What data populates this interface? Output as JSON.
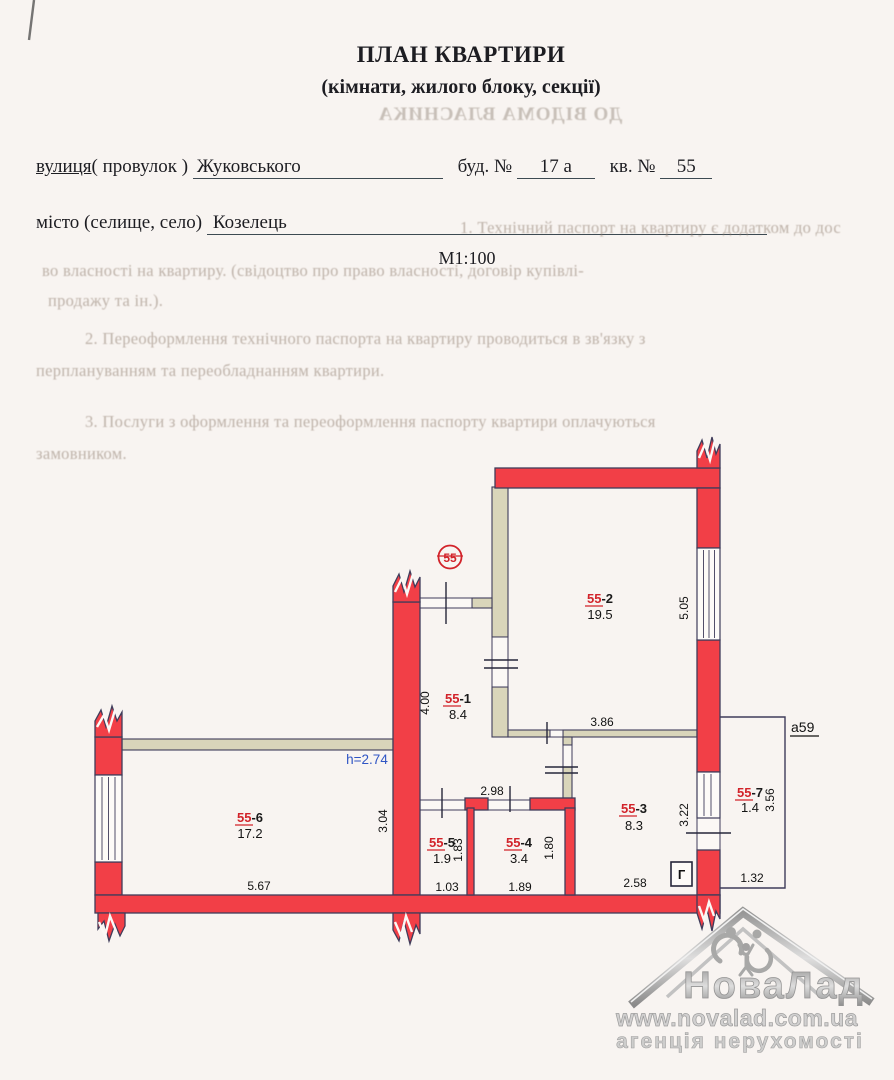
{
  "header": {
    "title": "ПЛАН КВАРТИРИ",
    "subtitle": "(кімнати, жилого блоку, секції)",
    "street_word": "вулиця",
    "street_rest": "( провулок )",
    "street_value": "Жуковського",
    "building_label": "буд. №",
    "building_value": "17 а",
    "apartment_label": "кв. №",
    "apartment_value": "55",
    "city_word1": "місто (",
    "city_word2": "селище",
    "city_word3": ", село)",
    "city_value": "Козелець",
    "scale": "М1:100"
  },
  "bleed_through": {
    "mirrored_notice": "ДО ВІДОМА ВЛАСНИКА",
    "lines": [
      "1. Технічний паспорт на квартиру є додатком до дос",
      "во власності на квартиру. (свідоцтво про право власності, договір купівлі-",
      "продажу та ін.).",
      "2. Переоформлення технічного паспорта на квартиру проводиться в зв'язку з",
      "перплануванням та переобладнанням квартири.",
      "3. Послуги з оформлення та переоформлення паспорту квартири оплачуються",
      "замовником."
    ]
  },
  "plan": {
    "apartment_badge": "55",
    "height_note": "h=2.74",
    "annex_label": "a59",
    "gas_label": "Г",
    "rooms": [
      {
        "num": "55",
        "suffix": "-1",
        "area": "8.4"
      },
      {
        "num": "55",
        "suffix": "-2",
        "area": "19.5"
      },
      {
        "num": "55",
        "suffix": "-3",
        "area": "8.3"
      },
      {
        "num": "55",
        "suffix": "-4",
        "area": "3.4"
      },
      {
        "num": "55",
        "suffix": "-5",
        "area": "1.9"
      },
      {
        "num": "55",
        "suffix": "-6",
        "area": "17.2"
      },
      {
        "num": "55",
        "suffix": "-7",
        "area": "1.4"
      }
    ],
    "dimensions": [
      "4.00",
      "5.05",
      "3.86",
      "2.98",
      "3.04",
      "1.83",
      "1.80",
      "3.22",
      "3.56",
      "5.67",
      "1.03",
      "1.89",
      "2.58",
      "1.32"
    ]
  },
  "watermark": {
    "brand": "НоваЛад",
    "url": "www.novalad.com.ua",
    "tagline": "агенція нерухомості"
  },
  "colors": {
    "wall_red": "#f23f47",
    "partition_beige": "#d9d5ba",
    "outline_dark": "#3f3c5a",
    "room_label_red": "#d2232a",
    "height_blue": "#2f55c4",
    "paper": "#f8f4f1"
  }
}
